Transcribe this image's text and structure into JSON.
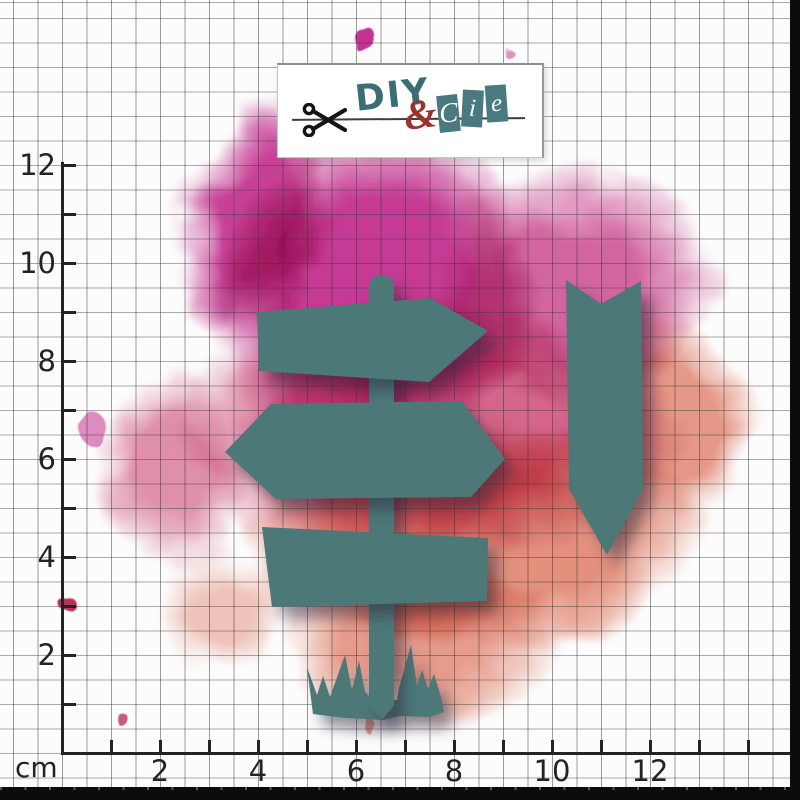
{
  "brand": {
    "diy": "DIY",
    "ampersand": "&",
    "cie_letters": [
      "C",
      "i",
      "e"
    ]
  },
  "ruler": {
    "unit": "cm",
    "vertical_labels": [
      "2",
      "4",
      "6",
      "8",
      "10",
      "12"
    ],
    "horizontal_labels": [
      "2",
      "4",
      "6",
      "8",
      "10",
      "12"
    ],
    "v_tick_count": 12,
    "h_tick_count": 14
  },
  "die_cut_shapes": [
    "arrow-sign-right",
    "double-arrow-sign",
    "plank-sign",
    "signpost-pole",
    "grass-tuft",
    "chevron-plant-marker"
  ],
  "colors": {
    "die_teal": "#4c7878",
    "splash_magenta": "#c2308e",
    "splash_magenta_light": "#cc4f93",
    "splash_pink": "#d0557f",
    "splash_salmon": "#e28a76",
    "splash_crimson": "#b93352",
    "logo_teal": "#3b6e74",
    "logo_red": "#9c322e",
    "cie_box_teal": "#4a7a80",
    "axis_ink": "#232323",
    "grid_line": "#6e6e6e"
  }
}
